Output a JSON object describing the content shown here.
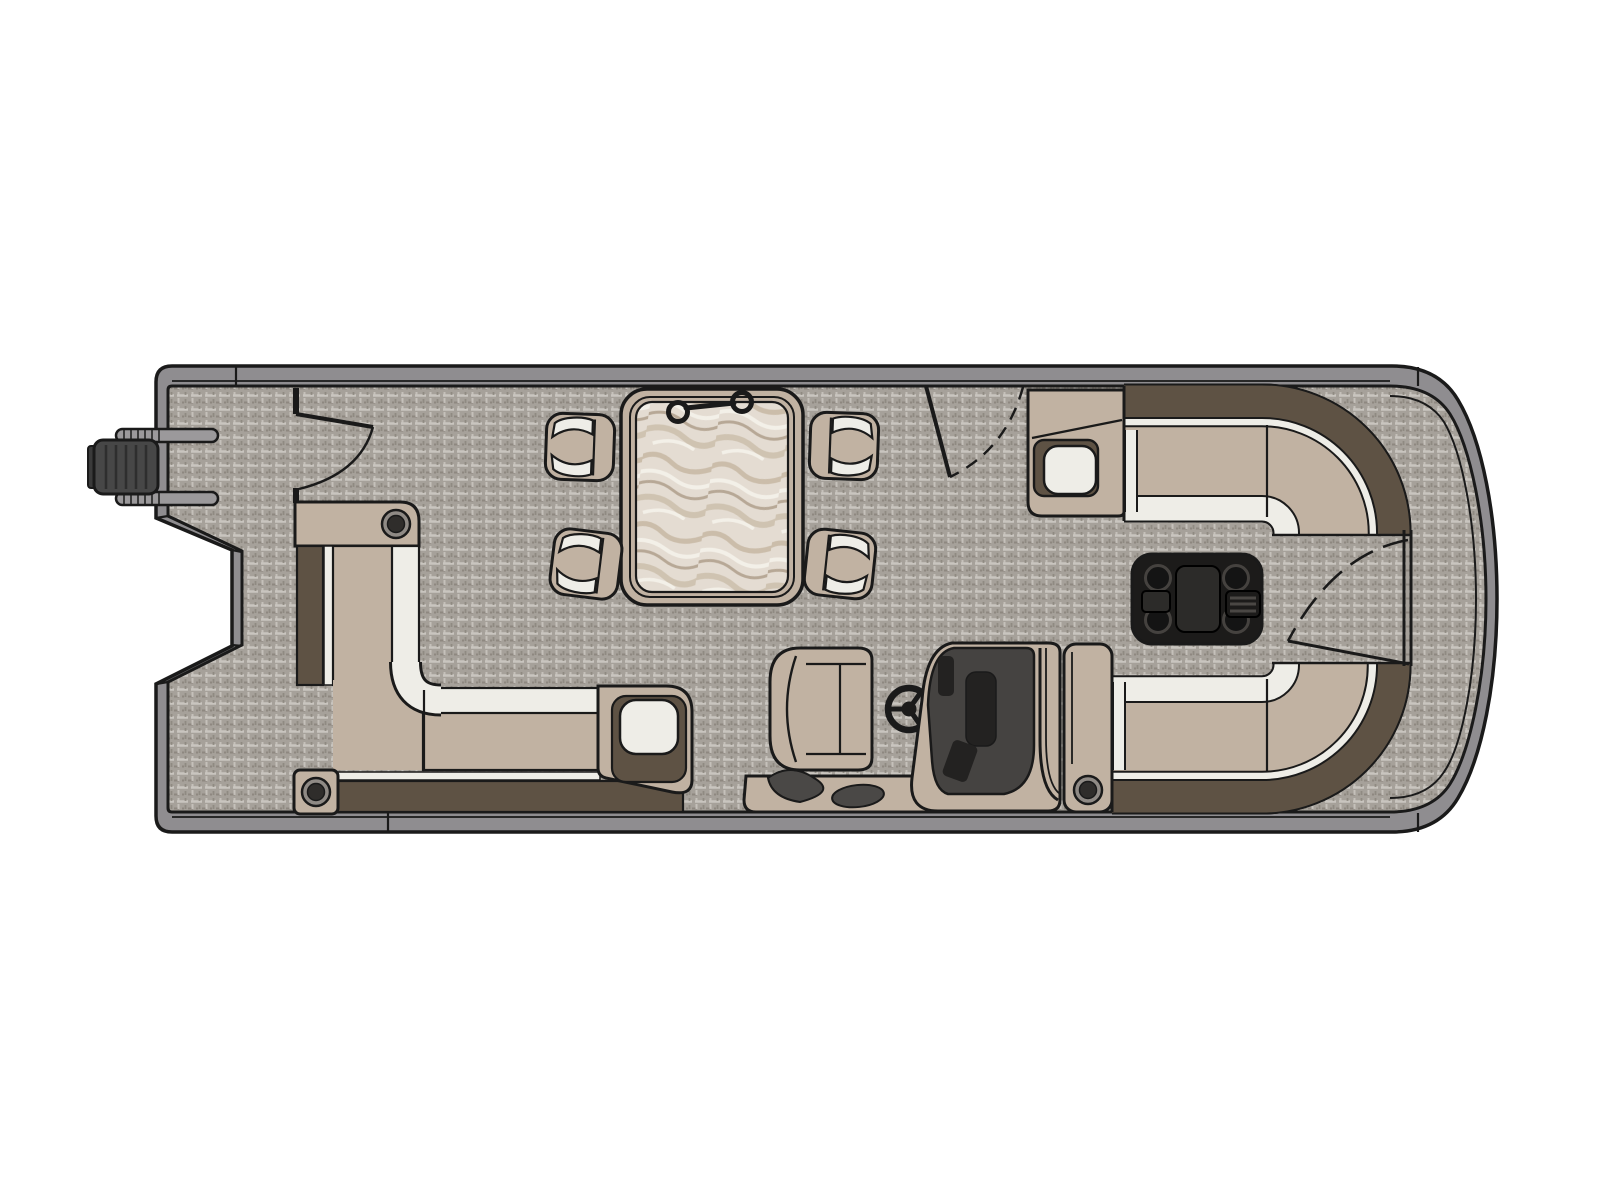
{
  "title": "Pontoon boat floor plan — top view",
  "colors": {
    "background": "#ffffff",
    "outline": "#1a1a1a",
    "hull_rim": "#8f8d90",
    "carpet_base": "#a6a19a",
    "carpet_light": "#c9c5bf",
    "carpet_dark": "#8a847c",
    "cushion_beige": "#c1b2a2",
    "cushion_white": "#eeede7",
    "backrest_brown": "#5e5244",
    "console_dark": "#454341",
    "screen_dark": "#232221",
    "black_parts": "#1c1b1a",
    "marble_base": "#e4dcd2",
    "marble_swirl": "#c7b8a3",
    "marble_deep": "#a4927c",
    "marble_light": "#f6f2ea",
    "motor_gray": "#474747",
    "bar_gray": "#9b999b",
    "cup_rim": "#8f8a85",
    "cup_dark": "#2f2d2b"
  },
  "components": {
    "hull": "Pontoon hull with rounded bow",
    "deck": "Woven vinyl deck flooring",
    "motor": "Outboard motor on stern",
    "stern_platform": "Stern platform",
    "stern_gate": "Port stern entry gate",
    "port_bench": "L-shaped port lounge with armrests and cup holders",
    "chaise_armrest": "Lounge end armrest with headrest pad",
    "dinette": "Dinette with marble-top table and four stools",
    "table_handle": "Table top handle",
    "stools": "Upholstered dinette stools",
    "helm": "Helm station",
    "captain_chair": "Captain's chair",
    "steering_wheel": "Steering wheel",
    "console": "Helm console with gauges",
    "console_armrest": "Console side armrest with cup holder",
    "starboard_gate": "Starboard boarding gate",
    "starboard_bow_lounge": "Starboard wrap-around bow lounge",
    "port_bow_lounge": "Port wrap-around bow lounge",
    "bow_armrest": "Bow lounge armrest with storage tray",
    "bow_table": "Black cocktail table with four cup holders",
    "bow_walkway": "Bow walkway",
    "bow_gate": "Bow boarding gate"
  }
}
